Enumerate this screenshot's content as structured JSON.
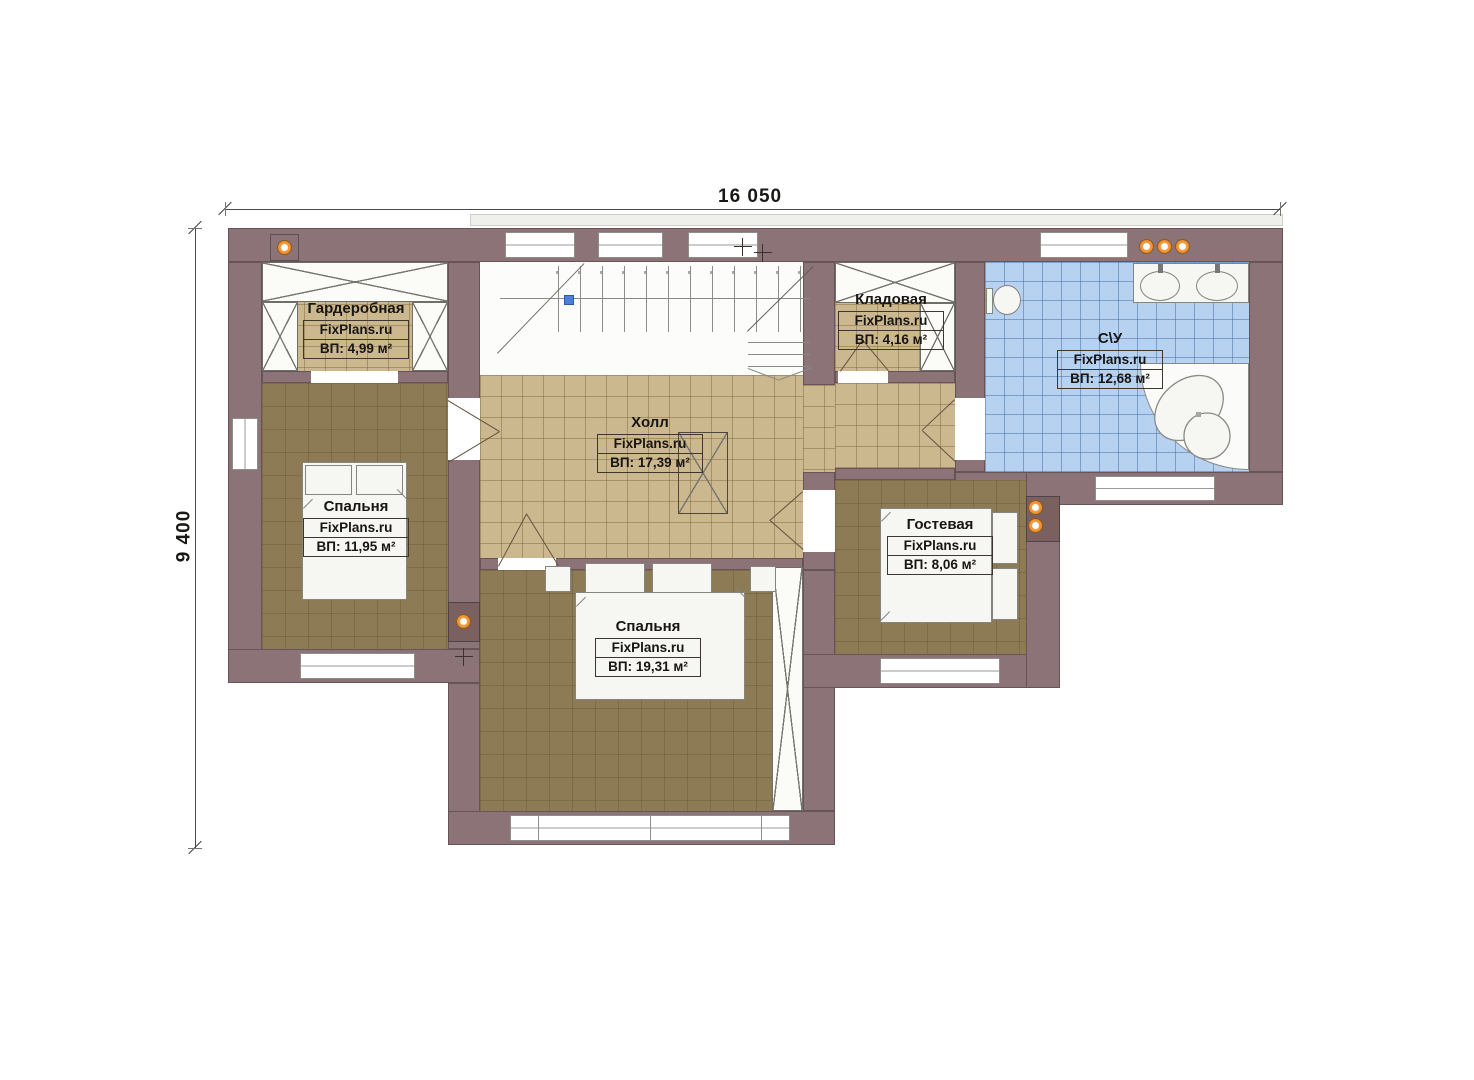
{
  "plan": {
    "dimensions": {
      "width": "16 050",
      "height": "9 400"
    },
    "watermark": "FixPlans.ru",
    "rooms": [
      {
        "name": "Гардеробная",
        "brand": "FixPlans.ru",
        "area": "ВП: 4,99 м²"
      },
      {
        "name": "Кладовая",
        "brand": "FixPlans.ru",
        "area": "ВП: 4,16 м²"
      },
      {
        "name": "С\\У",
        "brand": "FixPlans.ru",
        "area": "ВП: 12,68 м²"
      },
      {
        "name": "Холл",
        "brand": "FixPlans.ru",
        "area": "ВП: 17,39 м²"
      },
      {
        "name": "Спальня",
        "brand": "FixPlans.ru",
        "area": "ВП: 11,95 м²"
      },
      {
        "name": "Гостевая",
        "brand": "FixPlans.ru",
        "area": "ВП: 8,06 м²"
      },
      {
        "name": "Спальня",
        "brand": "FixPlans.ru",
        "area": "ВП: 19,31 м²"
      }
    ],
    "colors": {
      "wall": "#8b7377",
      "floor_tan": "#ccb88f",
      "floor_brown": "#8d7b55",
      "floor_blue": "#b6d2f0",
      "accent_orange": "#d96f16"
    }
  }
}
